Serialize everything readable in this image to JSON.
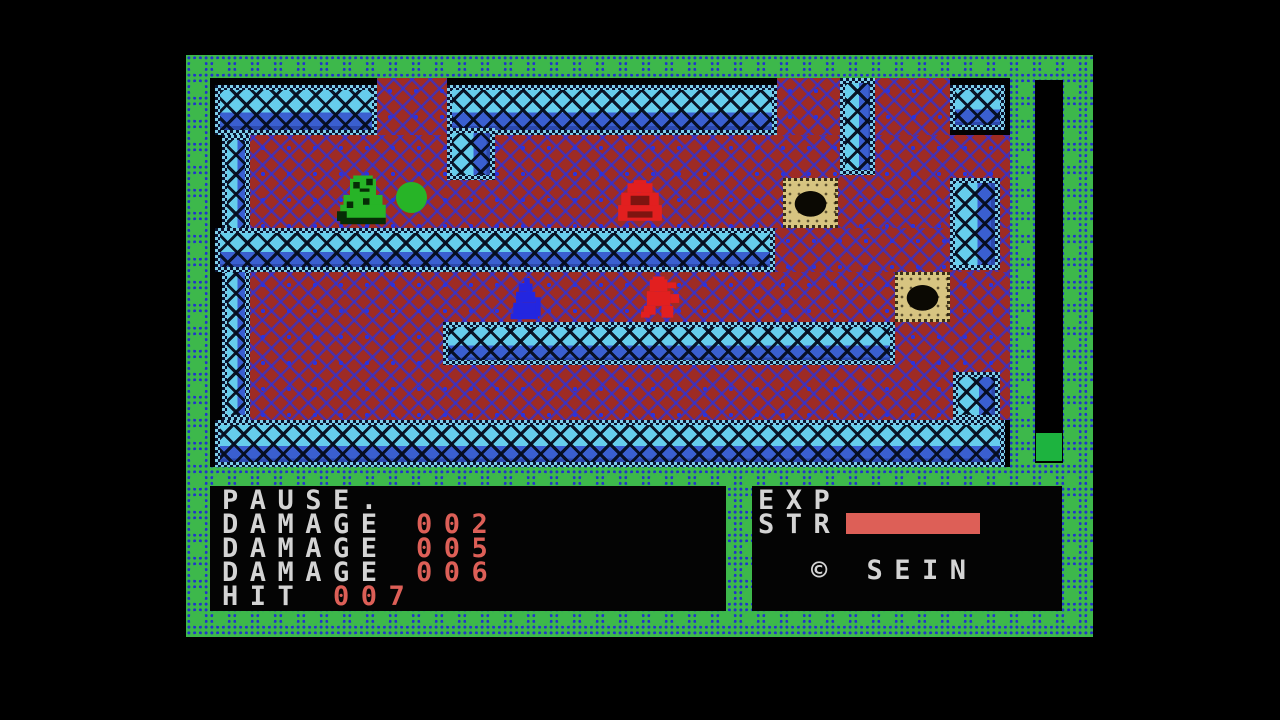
{
  "colors": {
    "background": "#000000",
    "border_green": "#3db84b",
    "border_dot_blue": "#2232cc",
    "wall_cyan": "#66cdec",
    "wall_blue": "#3a5fd0",
    "floor_red": "#9e2b24",
    "floor_pattern_blue": "#2b33dd",
    "block_tan": "#d7c481",
    "text_white": "#d4d4d4",
    "stat_red": "#dd5f57",
    "gauge_green": "#1db33f",
    "player_green": "#27b427",
    "enemy_red": "#e21f1f",
    "enemy_blue": "#2326e0"
  },
  "hud_left": {
    "pause_label": "PAUSE.",
    "stats": [
      {
        "label": "DAMAGE",
        "value": "002"
      },
      {
        "label": "DAMAGE",
        "value": "005"
      },
      {
        "label": "DAMAGE",
        "value": "006"
      },
      {
        "label": "HIT",
        "value": "007"
      }
    ]
  },
  "hud_right": {
    "exp_label": "EXP",
    "str_label": "STR",
    "credit": "© SEIN"
  },
  "gauge": {
    "fill_percent": 7
  },
  "entities": {
    "player": "green-hero",
    "orb": "green-power-orb",
    "enemy_upper": "red-blob-monster",
    "enemy_blue": "blue-robed-enemy",
    "enemy_lower": "red-imp-enemy",
    "block": "stone-block-with-hole"
  }
}
